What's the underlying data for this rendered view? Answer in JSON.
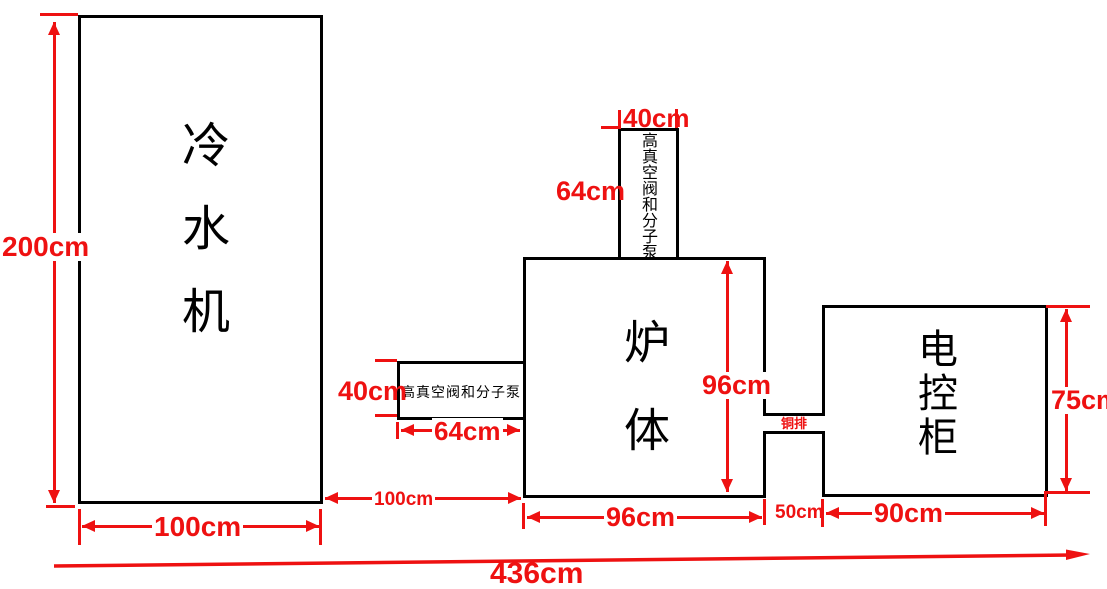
{
  "equipment": {
    "chiller": {
      "name": "冷水机",
      "width": "100cm",
      "height": "200cm"
    },
    "furnace": {
      "name": "炉体",
      "width": "96cm",
      "height": "96cm"
    },
    "top_pump": {
      "name": "高真空阀和分子泵",
      "width": "40cm",
      "height": "64cm"
    },
    "side_pump": {
      "name": "高真空阀和分子泵",
      "width": "64cm",
      "height": "40cm"
    },
    "busbar": {
      "name": "铜排",
      "width": "50cm"
    },
    "cabinet": {
      "name": "电控柜",
      "width": "90cm",
      "height": "75cm"
    }
  },
  "spacing": {
    "chiller_to_furnace": "100cm",
    "total_length": "436cm"
  },
  "colors": {
    "dimension_red": "#ee1111",
    "outline_black": "#000000",
    "background": "#ffffff"
  }
}
